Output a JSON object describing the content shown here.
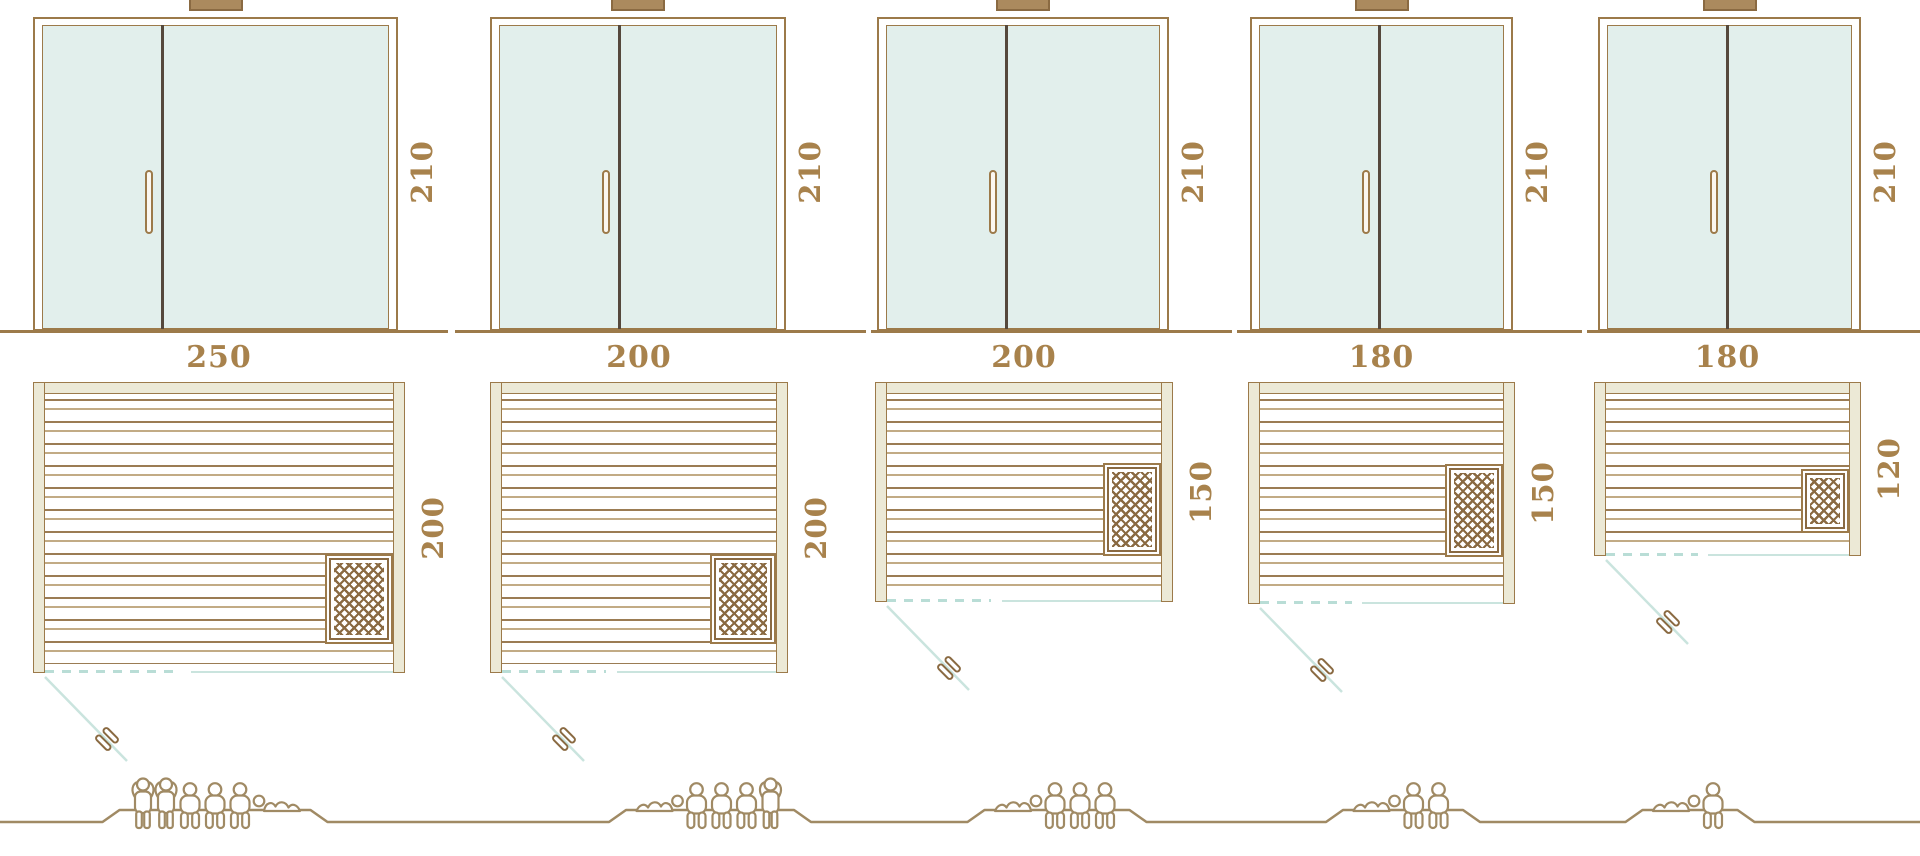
{
  "models": [
    {
      "id": "sauna-250x200",
      "door_height_label": "210",
      "width_label": "250",
      "depth_label": "200",
      "door_height_cm": 210,
      "width_cm": 250,
      "depth_cm": 200,
      "heater_position": "bottom-right",
      "capacity": {
        "total": 6,
        "standing": 2,
        "sitting": 3,
        "lying": 1,
        "sequence": [
          "standing",
          "standing",
          "sitting",
          "sitting",
          "sitting",
          "lying-feet-right"
        ]
      }
    },
    {
      "id": "sauna-200x200",
      "door_height_label": "210",
      "width_label": "200",
      "depth_label": "200",
      "door_height_cm": 210,
      "width_cm": 200,
      "depth_cm": 200,
      "heater_position": "bottom-right",
      "capacity": {
        "total": 5,
        "standing": 1,
        "sitting": 3,
        "lying": 1,
        "sequence": [
          "lying-feet-left",
          "sitting",
          "sitting",
          "sitting",
          "standing"
        ]
      }
    },
    {
      "id": "sauna-200x150",
      "door_height_label": "210",
      "width_label": "200",
      "depth_label": "150",
      "door_height_cm": 210,
      "width_cm": 200,
      "depth_cm": 150,
      "heater_position": "right-middle",
      "capacity": {
        "total": 4,
        "standing": 0,
        "sitting": 3,
        "lying": 1,
        "sequence": [
          "lying-feet-left",
          "sitting",
          "sitting",
          "sitting"
        ]
      }
    },
    {
      "id": "sauna-180x150",
      "door_height_label": "210",
      "width_label": "180",
      "depth_label": "150",
      "door_height_cm": 210,
      "width_cm": 180,
      "depth_cm": 150,
      "heater_position": "right-middle",
      "capacity": {
        "total": 3,
        "standing": 0,
        "sitting": 2,
        "lying": 1,
        "sequence": [
          "lying-feet-left",
          "sitting",
          "sitting"
        ]
      }
    },
    {
      "id": "sauna-180x120",
      "door_height_label": "210",
      "width_label": "180",
      "depth_label": "120",
      "door_height_cm": 210,
      "width_cm": 180,
      "depth_cm": 120,
      "heater_position": "bottom-right",
      "capacity": {
        "total": 2,
        "standing": 0,
        "sitting": 1,
        "lying": 1,
        "sequence": [
          "lying-feet-left",
          "sitting"
        ]
      }
    }
  ],
  "colors": {
    "outline_brown": "#9c7a4a",
    "dark_outline": "#8a6a42",
    "door_divider": "#55483c",
    "glass_teal": "#e2efec",
    "wall_beige": "#ece9d6",
    "bench_line_dark": "#9b7c54",
    "bench_line_light": "#c2ab85",
    "door_swing_teal": "#cae4de",
    "label_brown": "#a8824c",
    "people_outline": "#a08a64"
  }
}
